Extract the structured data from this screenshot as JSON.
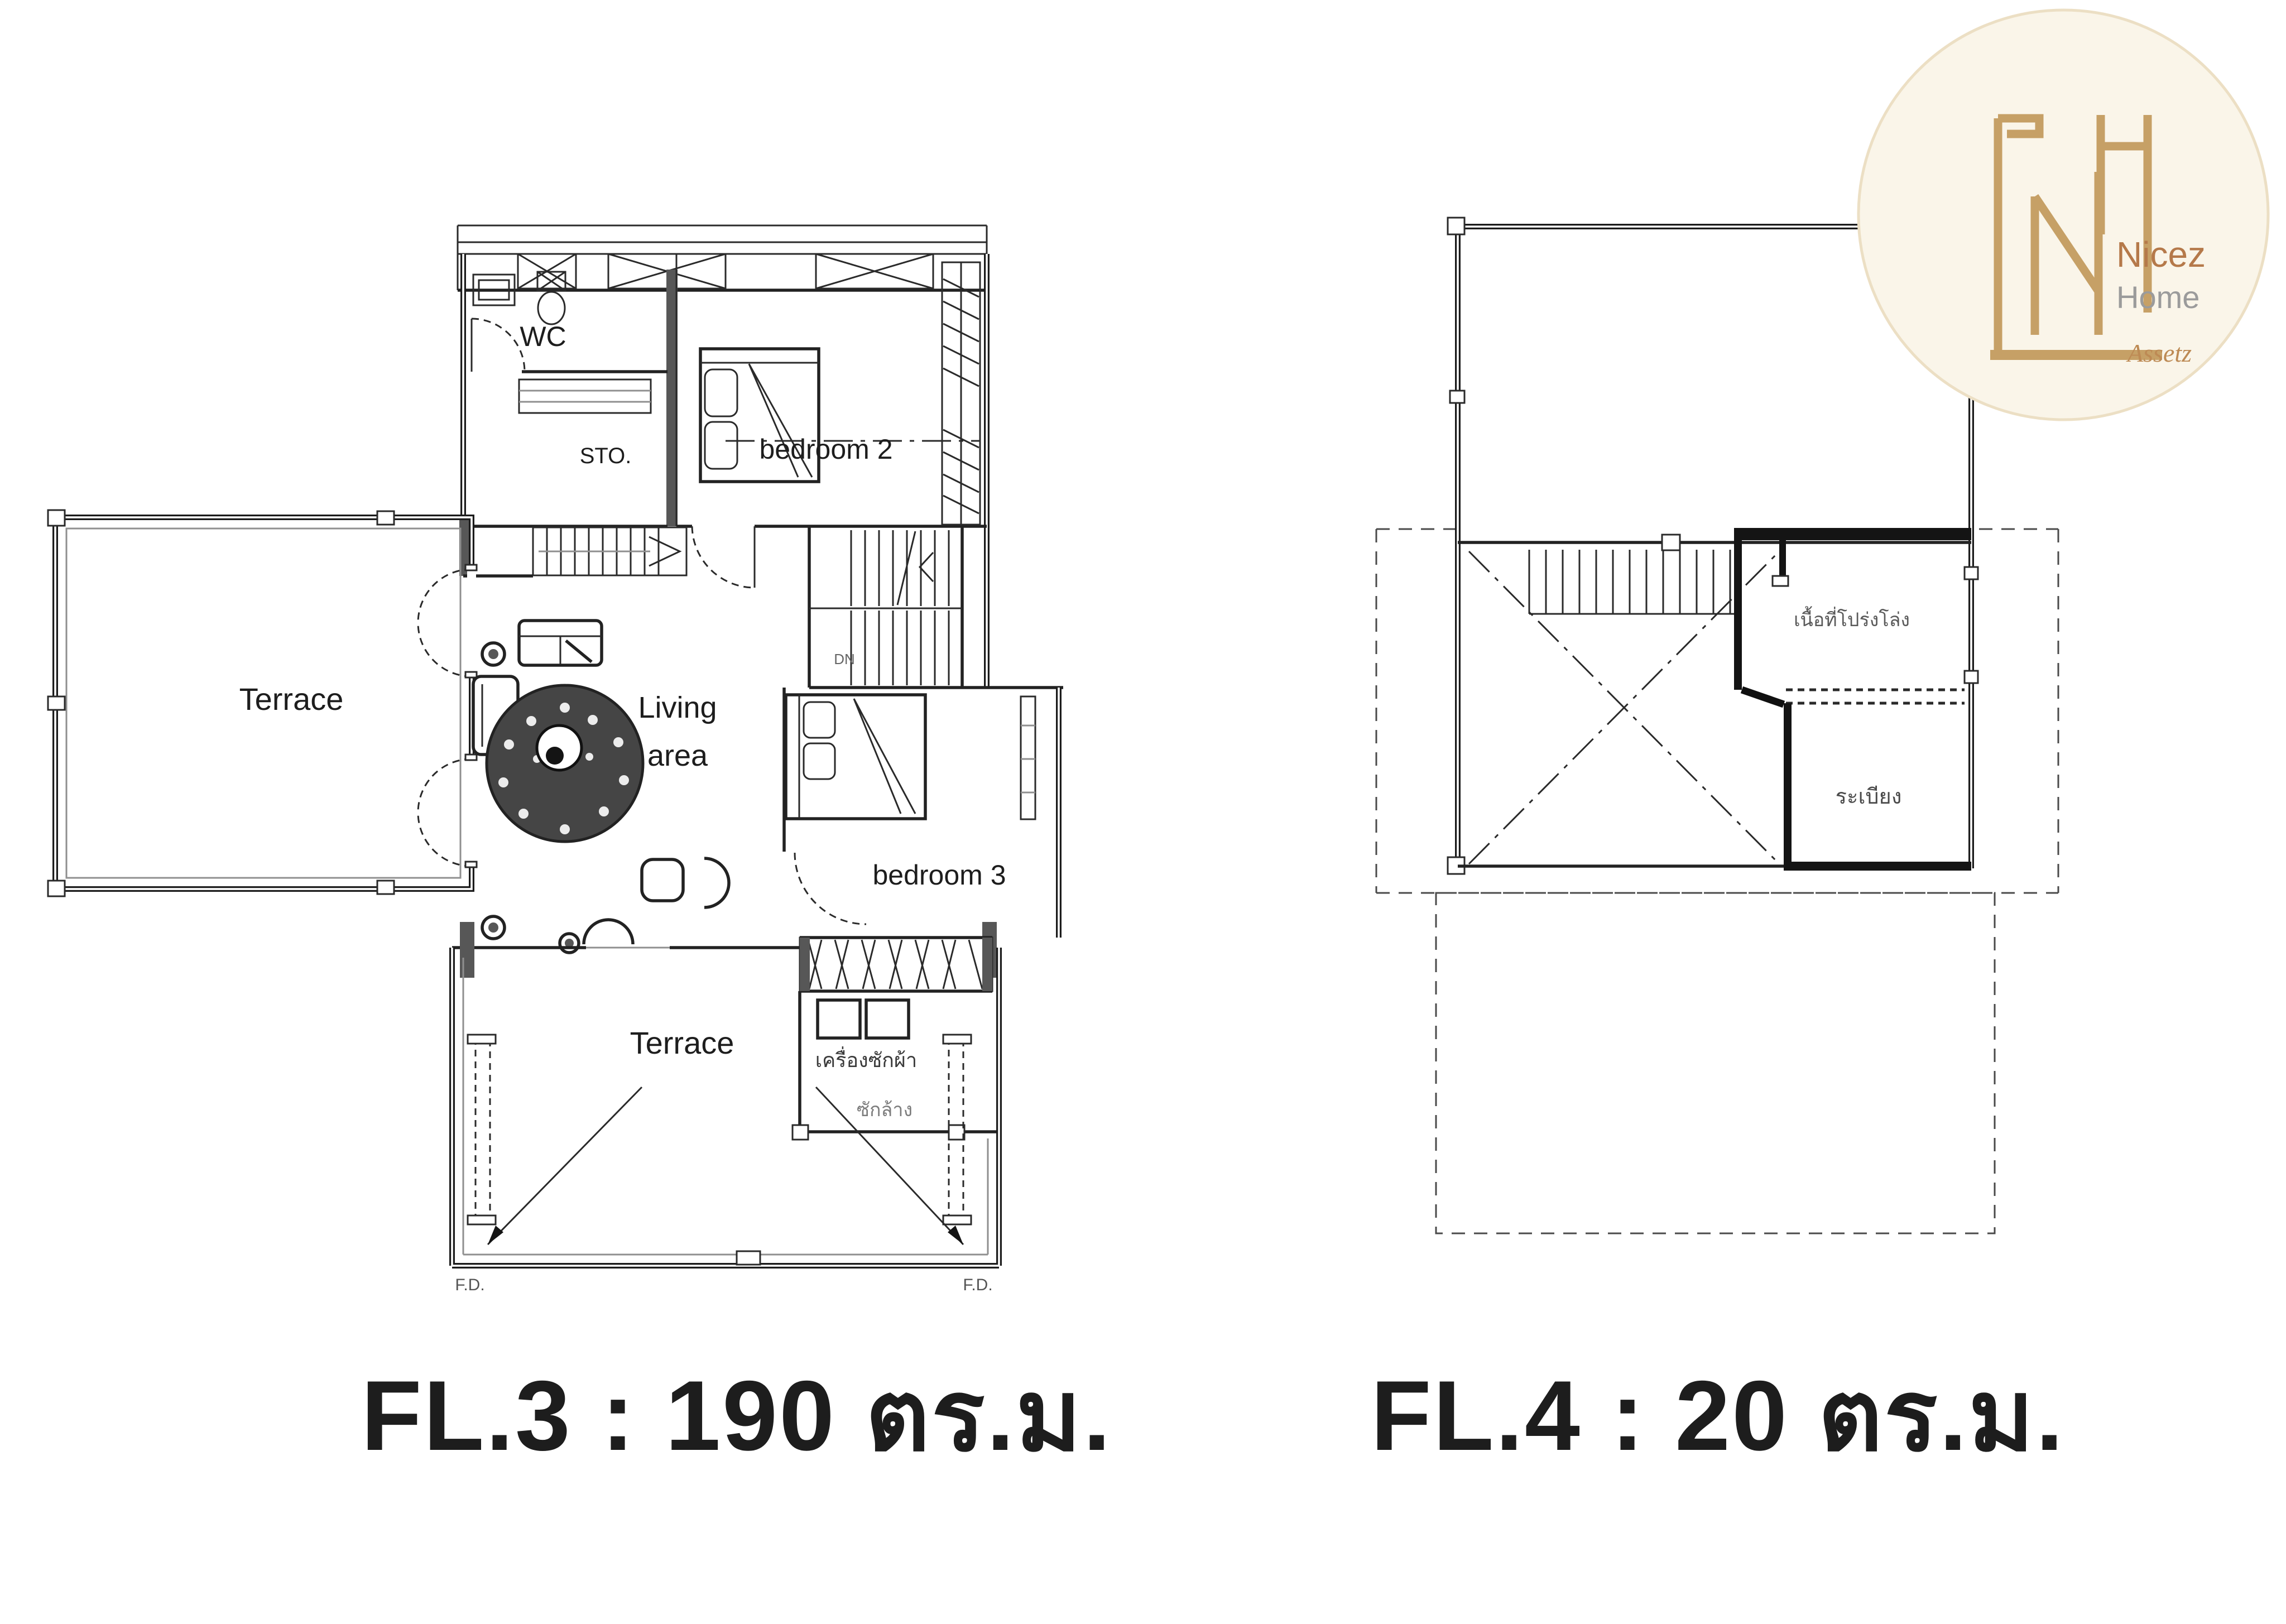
{
  "page": {
    "background": "#ffffff",
    "ink_color": "#1d1d1d",
    "wall_gray": "#575757",
    "line_gray": "#8f8f8f"
  },
  "floor3": {
    "caption": "FL.3 : 190 ตร.ม.",
    "rooms": {
      "wc": "WC",
      "sto": "STO.",
      "bedroom2": "bedroom 2",
      "living1": "Living",
      "living2": "area",
      "bedroom3": "bedroom 3",
      "terrace_left": "Terrace",
      "terrace_bottom": "Terrace",
      "dn": "DN",
      "washing_machine": "เครื่องซักผ้า",
      "wash_area": "ซักล้าง",
      "fd_left": "F.D.",
      "fd_right": "F.D."
    }
  },
  "floor4": {
    "caption": "FL.4 : 20 ตร.ม.",
    "rooms": {
      "open_area": "เนื้อที่โปร่งโล่ง",
      "balcony": "ระเบียง"
    }
  },
  "logo": {
    "name": "Nicez",
    "type": "Home",
    "suffix": "Assetz",
    "badge_color": "#faf5e9",
    "gold_color": "#c6a066"
  }
}
